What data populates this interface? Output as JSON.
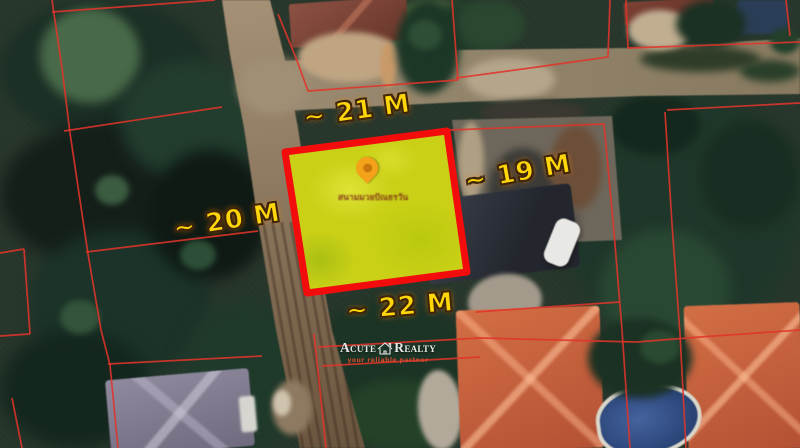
{
  "meta": {
    "description_label": "satellite land plot listing image"
  },
  "colors": {
    "boundary_red": "#e0342a",
    "plot_border_red": "#f20c0c",
    "plot_fill_yellow": "#c9d016",
    "label_yellow": "#ffd60a",
    "label_outline_brown": "#402508",
    "pin_orange": "#f5a21b",
    "watermark_white": "#f2f2f2",
    "tagline_orange": "#d14b2e"
  },
  "measurements": {
    "top": "~ 21 M",
    "right": "~ 19 M",
    "left": "~ 20 M",
    "bottom": "~ 22 M"
  },
  "plot": {
    "pin_label": "สนามมวยปัณธรวัน"
  },
  "watermark": {
    "brand_first": "Acute",
    "brand_second": "Realty",
    "tagline": "your reliable partner"
  }
}
